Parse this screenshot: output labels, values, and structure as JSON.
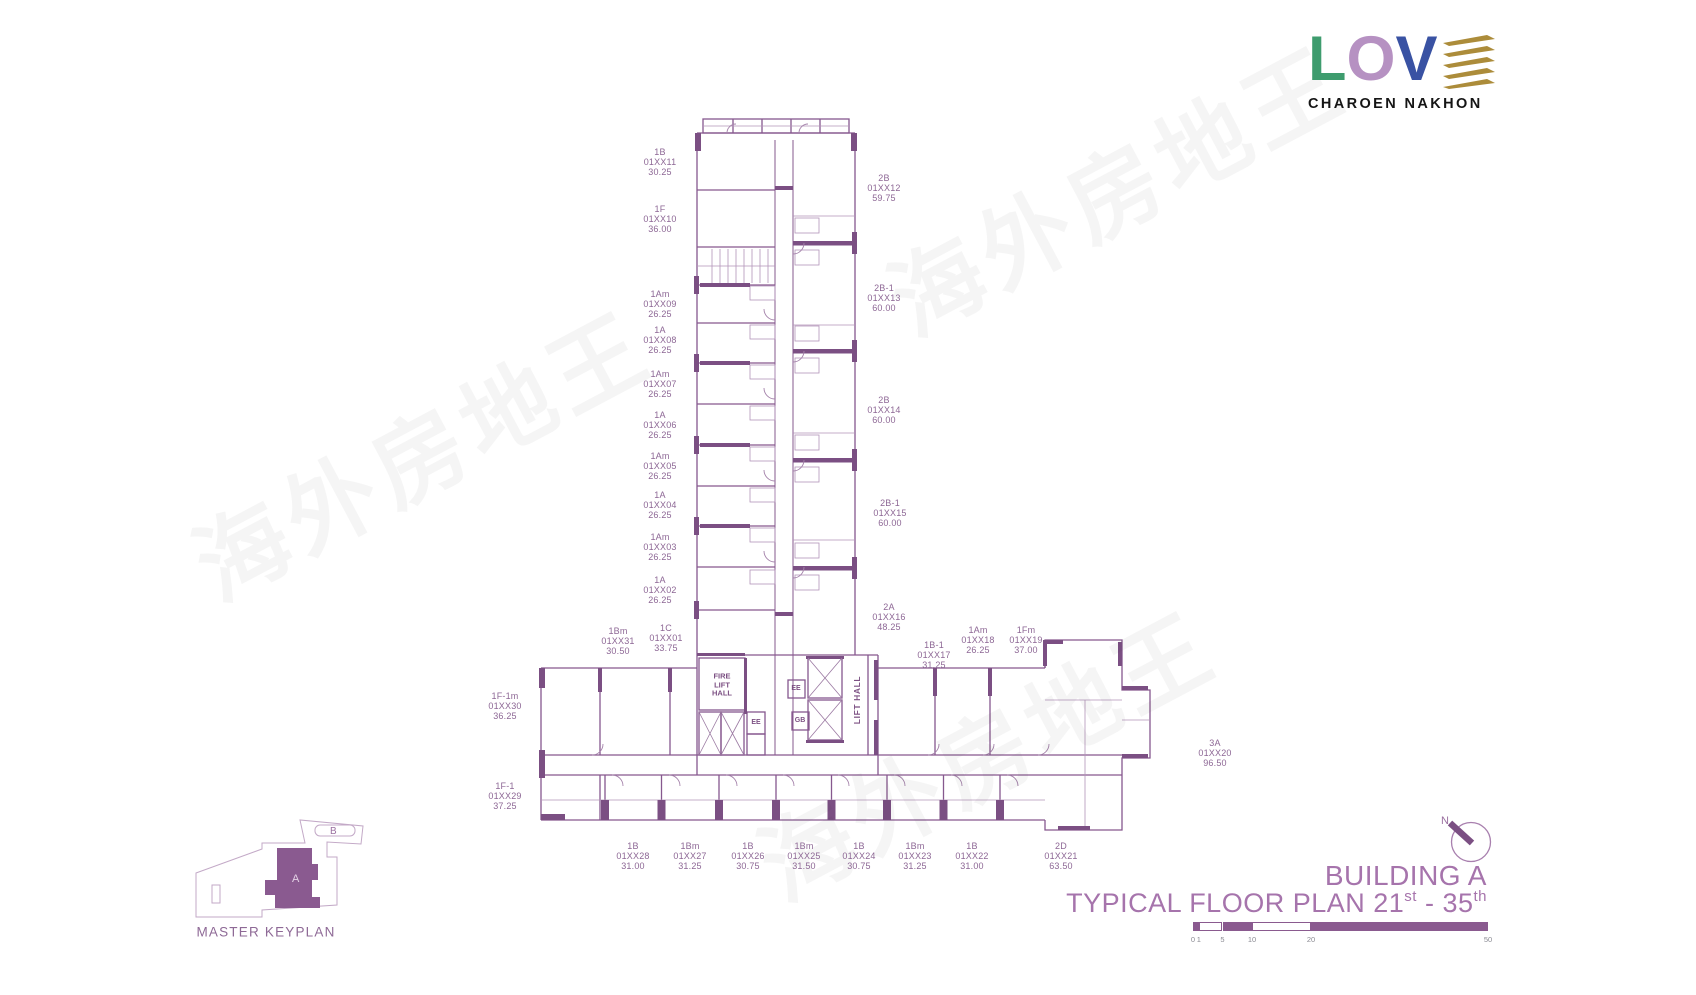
{
  "logo": {
    "letters": [
      {
        "ch": "L",
        "color": "#3e9c6e"
      },
      {
        "ch": "O",
        "color": "#b691c2"
      },
      {
        "ch": "V",
        "color": "#3952a3"
      }
    ],
    "stripes": {
      "count": 5,
      "color": "#ac8c3a"
    },
    "subtitle": "CHAROEN NAKHON"
  },
  "watermark": {
    "text": "海外房地王",
    "instances": [
      {
        "x": 1115,
        "y": 185
      },
      {
        "x": 420,
        "y": 450
      },
      {
        "x": 985,
        "y": 750
      }
    ]
  },
  "plan": {
    "core": {
      "fire_line1": "FIRE",
      "fire_line2": "LIFT",
      "fire_line3": "HALL",
      "ee": "EE",
      "gb": "GB",
      "lift_hall": "LIFT HALL"
    },
    "units": [
      {
        "type": "1B",
        "id": "01XX11",
        "area": "30.25",
        "x": 660,
        "y": 162
      },
      {
        "type": "1F",
        "id": "01XX10",
        "area": "36.00",
        "x": 660,
        "y": 219
      },
      {
        "type": "1Am",
        "id": "01XX09",
        "area": "26.25",
        "x": 660,
        "y": 304
      },
      {
        "type": "1A",
        "id": "01XX08",
        "area": "26.25",
        "x": 660,
        "y": 340
      },
      {
        "type": "1Am",
        "id": "01XX07",
        "area": "26.25",
        "x": 660,
        "y": 384
      },
      {
        "type": "1A",
        "id": "01XX06",
        "area": "26.25",
        "x": 660,
        "y": 425
      },
      {
        "type": "1Am",
        "id": "01XX05",
        "area": "26.25",
        "x": 660,
        "y": 466
      },
      {
        "type": "1A",
        "id": "01XX04",
        "area": "26.25",
        "x": 660,
        "y": 505
      },
      {
        "type": "1Am",
        "id": "01XX03",
        "area": "26.25",
        "x": 660,
        "y": 547
      },
      {
        "type": "1A",
        "id": "01XX02",
        "area": "26.25",
        "x": 660,
        "y": 590
      },
      {
        "type": "1Bm",
        "id": "01XX31",
        "area": "30.50",
        "x": 618,
        "y": 641
      },
      {
        "type": "1C",
        "id": "01XX01",
        "area": "33.75",
        "x": 666,
        "y": 638
      },
      {
        "type": "1F-1m",
        "id": "01XX30",
        "area": "36.25",
        "x": 505,
        "y": 706
      },
      {
        "type": "1F-1",
        "id": "01XX29",
        "area": "37.25",
        "x": 505,
        "y": 796
      },
      {
        "type": "2B",
        "id": "01XX12",
        "area": "59.75",
        "x": 884,
        "y": 188
      },
      {
        "type": "2B-1",
        "id": "01XX13",
        "area": "60.00",
        "x": 884,
        "y": 298
      },
      {
        "type": "2B",
        "id": "01XX14",
        "area": "60.00",
        "x": 884,
        "y": 410
      },
      {
        "type": "2B-1",
        "id": "01XX15",
        "area": "60.00",
        "x": 890,
        "y": 513
      },
      {
        "type": "2A",
        "id": "01XX16",
        "area": "48.25",
        "x": 889,
        "y": 617
      },
      {
        "type": "1B-1",
        "id": "01XX17",
        "area": "31.25",
        "x": 934,
        "y": 655
      },
      {
        "type": "1Am",
        "id": "01XX18",
        "area": "26.25",
        "x": 978,
        "y": 640
      },
      {
        "type": "1Fm",
        "id": "01XX19",
        "area": "37.00",
        "x": 1026,
        "y": 640
      },
      {
        "type": "3A",
        "id": "01XX20",
        "area": "96.50",
        "x": 1215,
        "y": 753
      },
      {
        "type": "1B",
        "id": "01XX28",
        "area": "31.00",
        "x": 633,
        "y": 856
      },
      {
        "type": "1Bm",
        "id": "01XX27",
        "area": "31.25",
        "x": 690,
        "y": 856
      },
      {
        "type": "1B",
        "id": "01XX26",
        "area": "30.75",
        "x": 748,
        "y": 856
      },
      {
        "type": "1Bm",
        "id": "01XX25",
        "area": "31.50",
        "x": 804,
        "y": 856
      },
      {
        "type": "1B",
        "id": "01XX24",
        "area": "30.75",
        "x": 859,
        "y": 856
      },
      {
        "type": "1Bm",
        "id": "01XX23",
        "area": "31.25",
        "x": 915,
        "y": 856
      },
      {
        "type": "1B",
        "id": "01XX22",
        "area": "31.00",
        "x": 972,
        "y": 856
      },
      {
        "type": "2D",
        "id": "01XX21",
        "area": "63.50",
        "x": 1061,
        "y": 856
      }
    ]
  },
  "keyplan": {
    "label": "MASTER KEYPLAN",
    "building_a": "A",
    "building_b": "B"
  },
  "north": {
    "label": "N"
  },
  "title": {
    "line1": "BUILDING A",
    "line2_pre": "TYPICAL FLOOR PLAN 21",
    "line2_sup1": "st",
    "line2_mid": " - 35",
    "line2_sup2": "th"
  },
  "scale_bar": {
    "ticks": [
      {
        "v": 0,
        "label": "0"
      },
      {
        "v": 1,
        "label": "1"
      },
      {
        "v": 5,
        "label": "5"
      },
      {
        "v": 10,
        "label": "10"
      },
      {
        "v": 20,
        "label": "20"
      },
      {
        "v": 50,
        "label": "50"
      }
    ],
    "segments": [
      {
        "from": 0,
        "to": 1,
        "filled": true
      },
      {
        "from": 1,
        "to": 5,
        "filled": false
      },
      {
        "from": 5,
        "to": 10,
        "filled": true
      },
      {
        "from": 10,
        "to": 20,
        "filled": false
      },
      {
        "from": 20,
        "to": 50,
        "filled": true
      }
    ]
  }
}
